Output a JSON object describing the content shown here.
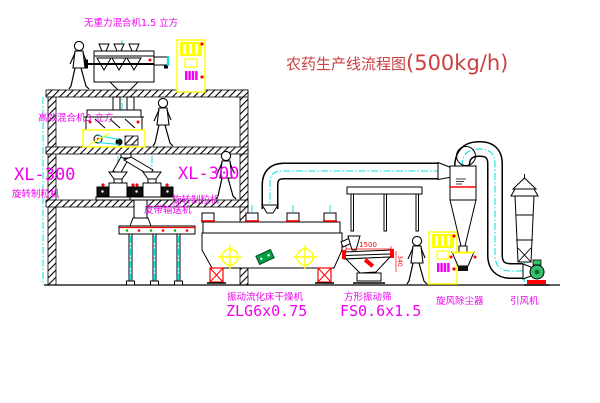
{
  "title": {
    "name": "农药生产线流程图",
    "capacity": "(500kg/h)"
  },
  "equipment_labels": {
    "gravity_free_mixer": "无重力混合机1.5 立方",
    "high_efficiency_mixer": "高效混合机3 立方",
    "granulator_left_model": "XL-300",
    "granulator_left_name": "旋转制粒机",
    "granulator_right_model": "XL-300",
    "granulator_right_name": "旋转制粒机",
    "belt_conveyor": "皮带输送机",
    "fluid_bed_dryer_name": "振动流化床干燥机",
    "fluid_bed_dryer_model": "ZLG6x0.75",
    "square_vibrating_sieve_name": "方形振动筛",
    "square_vibrating_sieve_model": "FS0.6x1.5",
    "cyclone_dust_collector": "旋风除尘器",
    "induced_draft_fan": "引风机"
  },
  "dimensions": {
    "sieve_length": "1500",
    "sieve_height": "340"
  },
  "colors": {
    "label_magenta": "#f000f0",
    "title_red": "#c94040",
    "centerline_cyan": "#00e0e0",
    "accent_yellow": "#ffff00",
    "accent_red": "#ff0000",
    "line_black": "#000000",
    "background": "#ffffff"
  }
}
